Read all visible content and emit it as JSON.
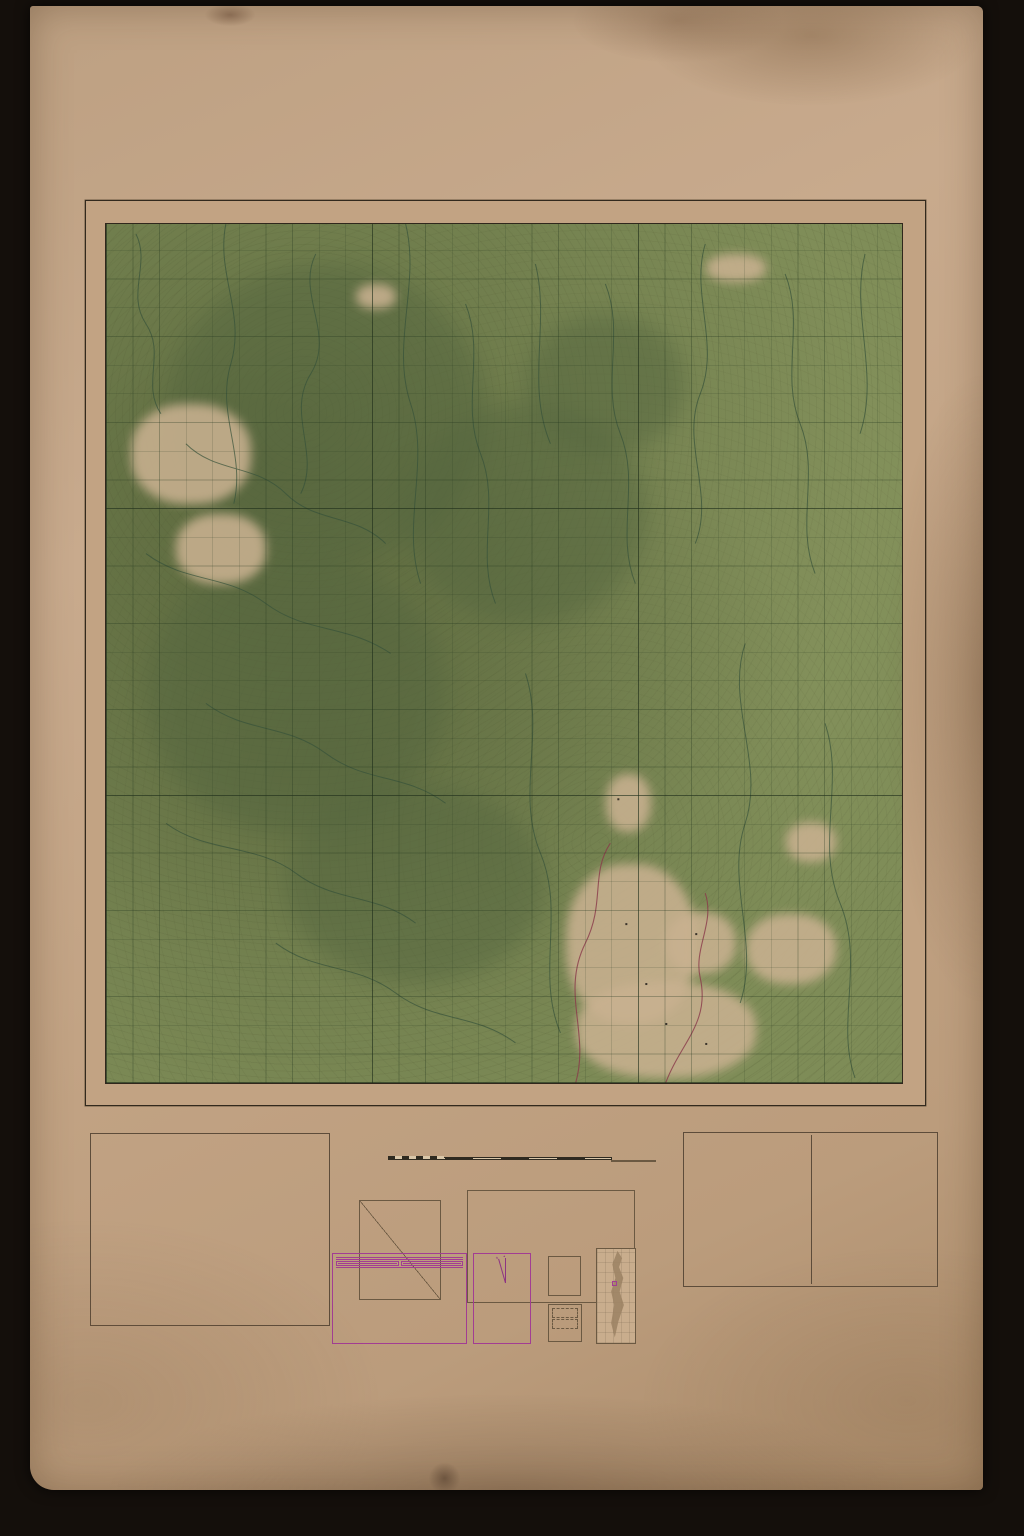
{
  "colors": {
    "paper": "#c2a384",
    "map_green": "#7e8c57",
    "forest_dark": "#55663f",
    "overprint_purple": "#5f2864",
    "magenta": "#a23d93",
    "emergency_magenta": "#b1308f",
    "road_red": "#96452f"
  },
  "header": {
    "districts_note": "PART OF DISTRICTS KINTA, KUALA KANGSAR (PERAK), ULU KELANTAN (KELANTAN) & CAMERON HIGHLANDS (PAHANG)",
    "title_line1": "PERAK,",
    "title_line2": "KELANTAN & PAHANG",
    "series_prefix": "AIR RECONNAISSANCE MAP 2",
    "series_fraction_top": "N",
    "series_fraction_bottom": "6",
    "sheet_name": "GUNONG KORBU"
  },
  "map": {
    "top_label_left": "KUALA KANGSAR",
    "top_label_right": "ULU KELANTAN",
    "bottom_label_left": "K I N T A",
    "bottom_label_right": "CAMERON HIGHLANDS",
    "left_label": "K I N T A",
    "right_label_top": "ULU KELANTAN",
    "right_label_bottom": "CAMERON HIGHLANDS",
    "overprint": "V K",
    "grid_cols": [
      "+10",
      "11",
      "12",
      "13",
      "14",
      "15",
      "16",
      "17",
      "18",
      "19",
      "+20",
      "21",
      "22",
      "23",
      "24",
      "25",
      "26",
      "27",
      "28",
      "29",
      "+30",
      "31",
      "32",
      "33",
      "34",
      "35",
      "36",
      "37",
      "38",
      "39"
    ],
    "grid_rows": [
      "+90",
      "89",
      "88",
      "87",
      "86",
      "85",
      "84",
      "83",
      "82",
      "81",
      "+80",
      "79",
      "78",
      "77",
      "76",
      "75",
      "74",
      "73",
      "72",
      "71",
      "+70",
      "69",
      "68",
      "67",
      "66",
      "65",
      "64",
      "63",
      "62",
      "61"
    ],
    "interior_labels": {
      "forest_reserve_1": "KORBU  FOREST  RESERVE",
      "forest_reserve_2": "KINTA  HILLS  FOREST  RESERVE",
      "jungle": "Jungle",
      "batu_gangan": "BATU GANGAN"
    },
    "corner_note": "101° 15´ E. of Greenwich",
    "watermark": "National Archives of Singapore"
  },
  "reference": {
    "title": "R E F E R E N C E",
    "rows": [
      {
        "c": "Railways",
        "t": "with Mile plate and Railway Station",
        "s": "railway"
      },
      {
        "t": "(1) Road under   (2) Road over   (3) Level Crossing   (4) Tunnel",
        "s": "railway"
      },
      {
        "c": "Bridges",
        "t": "Iron, Masonry, Reinforced Concrete, Wooden, Foot",
        "s": "bridge"
      },
      {
        "c": "Roads",
        "t": "1st Class metalled (unmetalled) with mile stone",
        "s": "road"
      },
      {
        "t": "2nd Class metalled or gravel but with possible restrictions as to load and/or width and surface",
        "s": "road"
      },
      {
        "t": "generally inferior to 1st class",
        "s": "road"
      },
      {
        "t": "Indifferent, may be used by motor vehicles but with difficulty and with restrictions",
        "s": "roaddash"
      },
      {
        "t": "Cart or Jeep track.   Footpath",
        "s": "track"
      },
      {
        "c": "Boundaries",
        "t": "(1) International   (2) State   (3) District",
        "s": "boundary"
      },
      {
        "t": "Forest Reserve with path.   Without path",
        "s": "boundary"
      },
      {
        "t": "Lines of Cultivation.   Wall or Fence",
        "s": "fence"
      },
      {
        "t": "Light railway.   Electric transmission line",
        "s": "line"
      },
      {
        "t": "Cemetery.   Buildings.   Lighthouse",
        "s": "buildings"
      },
      {
        "c": "Heights",
        "t": "Trigonometrical station with height.   Bench mark",
        "sym": "△7102   BM 4088"
      },
      {
        "t": "Theodolite or level.   Relative.   Other heights",
        "sym": "·4262   ·3976"
      },
      {
        "c": "Coastal features",
        "t": "(1) Sand   (2) Rocks   (3) Tidal river",
        "s": "blue"
      },
      {
        "t": "Lake and pond.   Service reservoir.   Impounding reservoir",
        "s": "blue"
      },
      {
        "c": "N.B. features",
        "t": "(1) Rocky outcrop   (2) Cliff, Precipice",
        "s": "rock"
      },
      {
        "t": "(3) Quarry   (4) Landslide",
        "s": "rock"
      },
      {
        "c": "Mines",
        "t": "(1) Mining land   (2) Mine hole with water",
        "s": "mine"
      },
      {
        "t": "(3) Mine hole without water",
        "s": "mine"
      },
      {
        "c": "Swamps",
        "t": "(1) Fresh water   (2) Tidal   (3) Lipak",
        "s": "swamp"
      },
      {
        "t": "Court House, Rest House, Halting Bungalow, Hospital",
        "sym": "C.H.  R.H.  H.B.  Hosp."
      },
      {
        "t": "Customs Station, Radio Station, Meteorological Station",
        "sym": "Cus.  R.S.  Met."
      },
      {
        "t": "Forest Reserve, Forest Checking Station, Dispensary, Padang",
        "sym": "F.R.  F.C.S.  Disp.  Pdg."
      },
      {
        "t": "Post & Telegraph Office,  Post Office",
        "sym": "P.T.O.   P.O."
      },
      {
        "t": "Police Station, Petrol Filling Station, School",
        "sym": "P.S.  P.F.S.  Sch."
      },
      {
        "t": "Co-ordinated Central Point.   Rifle Range",
        "sym": "⊕   Rifle Range"
      }
    ],
    "footer": "Published under the direction of the Surveyor General, Malaya."
  },
  "scale": {
    "projection": "Projection :   Modified Polyconic",
    "copyright_lines": [
      "Government Copyright reserved.",
      "This map may not be reproduced",
      "without the permission of the",
      "Survey Dept., Federation of Malaya."
    ],
    "scale_text": "Scale 1 Inch to a Mile or 1:63,360",
    "mile_left": "Mile 1",
    "mile_right": "2 Miles",
    "heights": "Heights in Feet",
    "diag": {
      "top": "17·58 Miles",
      "bottom": "17·58 Miles",
      "left": "19·82 Miles",
      "right": "19·82 Miles",
      "across": "26·46 Miles"
    }
  },
  "vegetation": {
    "title": "Vegetation",
    "subtitle": "By limit and name or abbreviation in black",
    "head_natural": "Natural",
    "head_tree": "Tree Cultivation",
    "head_minor": "Minor Cultivation",
    "natural": [
      [
        "Jungle: Dense Forest",
        "Jle"
      ],
      [
        "Belukar: Light Forest",
        "Blr. L.F."
      ],
      [
        "Grass. Casuarina Forest",
        "Gr. C.F."
      ],
      [
        "Brush",
        "Br."
      ],
      [
        "Grass and Brush",
        "G.B."
      ],
      [
        "Grass and Belukar",
        "G.Blr."
      ],
      [
        "Mangrove",
        "M."
      ],
      [
        "Other Classified",
        "By name"
      ],
      [
        "Clearings",
        "Cl."
      ]
    ],
    "tree": [
      [
        "Rubber",
        "R."
      ],
      [
        "Coconut",
        "Co."
      ],
      [
        "Oil Palm",
        "O.P."
      ],
      [
        "Other Classified",
        "By name"
      ],
      [
        "Unclassified and Mixed",
        "V.X."
      ]
    ],
    "minor": [
      [
        "Wet Rice Fields",
        "Pdi. Pa."
      ],
      [
        "Other Classified",
        "By name"
      ],
      [
        "Unclassified",
        "M.C."
      ]
    ]
  },
  "gridref": {
    "title": "TO GIVE A GRID REFERENCE ON THIS SHEET",
    "note1": "Map references are to the nearest hundred metres by the system of squares printed on this sheet",
    "note2": "PAY ATTENTION TO LARGER MARGINAL FIGURES  viz  +10",
    "point_label": "POINT",
    "point_value": "G. Yong Belar (Trig.)",
    "east_head": "EAST",
    "north_head": "NORTH",
    "east_text": "Take west edge of the square in which point lies and read the figures printed opposite on the north or south margin. Estimate tenths eastwards.",
    "east_val": "31·5",
    "north_text": "Take south edge of the square in which point lies and read the figures printed opposite on the east or west margin. Estimate tenths northwards.",
    "north_val": "72·5",
    "footer_left": "EAST  315",
    "footer_right": "NORTH  725",
    "ref_line": "REFERENCE   315725"
  },
  "magnetic": {
    "title": "MAGNETIC DECLINATION ABOUT",
    "value": "1° 00´ E. (JAN. 1948)",
    "annual": "Annual change negligible",
    "grid_title": "MALAYAN GRID",
    "rows": [
      [
        "PROJECTION",
        "CASSINI"
      ],
      [
        "BEARINGS",
        "GRID"
      ],
      [
        "ORIGIN",
        "4° N., 102° E."
      ],
      [
        "FALSE COORDS.",
        "OF ORIGIN"
      ],
      [
        "500,000 YDS. E.",
        "0 YDS. N."
      ]
    ]
  },
  "reliability": {
    "title": "RELIABILITY",
    "regions": [
      "1",
      "2",
      "3"
    ],
    "note": "SEE NOTES"
  },
  "photos": {
    "title": "Index to Photographs"
  },
  "adjoining": {
    "title": "Index to adjoining sheets",
    "cells": [
      "",
      "2 N/2",
      "",
      "2 N/5",
      "2 N/6",
      "2 N/7",
      "",
      "2 N/10",
      ""
    ]
  },
  "glossary": {
    "title": "GLOSSARY OF MALAY TOPOGRAPHICAL TERMS WITH ABBREVIATIONS USED",
    "left": [
      [
        "Alur  (A.)",
        "Deep channel of river, hollow, pass"
      ],
      [
        "Ayer",
        "Water"
      ],
      [
        "Ayer Terjun",
        "Waterfall"
      ],
      [
        "Bagan",
        "Landing place, fishing village"
      ],
      [
        "Batu",
        "Stone, rock"
      ],
      [
        "Belukar  (Blk.)",
        "Secondary jungle"
      ],
      [
        "Bendang",
        "Rice swamp"
      ],
      [
        "Bukit  (Bt.)",
        "Hill"
      ],
      [
        "Changkat  (Chat.)",
        "Hillock"
      ],
      [
        "Charok  (C.)",
        "Small stream"
      ],
      [
        "Danau",
        "Fresh water pond"
      ],
      [
        "Genting  (Gtg.)",
        "Pass, col"
      ],
      [
        "Gunong  (G.)",
        "Mountain"
      ],
      [
        "Hilir  (Hr.)",
        "Downstream region"
      ],
      [
        "Istana",
        "Palace"
      ],
      [
        "Jalan",
        "Road, way"
      ],
      [
        "Jeram  (J.)",
        "Rapids"
      ],
      [
        "Kampong  (Kg.)",
        "Village"
      ],
      [
        "Kota",
        "Fort"
      ],
      [
        "Kuala  (K.)",
        "River mouth"
      ],
      [
        "Kubang",
        "Wallow"
      ],
      [
        "Labohan",
        "Anchorage"
      ],
      [
        "Ladang  (Ldg.)",
        "Cultivated clearing"
      ],
      [
        "Lalang  (L.)",
        "Long wild grass"
      ],
      [
        "Laut",
        "Sea"
      ],
      [
        "Lepah",
        "Depression, swamp"
      ]
    ],
    "right": [
      [
        "Lubok  (Lbk.)",
        "Deep pool"
      ],
      [
        "Nipah  (Nip.)",
        "Palm used for thatching"
      ],
      [
        "Padang  (Pdg.)",
        "Open space, sports field, marshland"
      ],
      [
        "Pantai",
        "Beach"
      ],
      [
        "Parit  (Pt.)",
        "Ditch, drain"
      ],
      [
        "Pasir",
        "Sand"
      ],
      [
        "Paya",
        "Permanent swamp"
      ],
      [
        "Pangkalan  (Peng.)",
        "Wharf"
      ],
      [
        "Permatang  (Pmtg.)",
        "Rising ground in flat country"
      ],
      [
        "Pulau  (P.)",
        "Island"
      ],
      [
        "Rantau",
        "Reach of river or of sea coast"
      ],
      [
        "Rasau",
        "Fern, riverine"
      ],
      [
        "Rimba",
        "Virgin jungle"
      ],
      [
        "Rumbia",
        "Palm used for thatching"
      ],
      [
        "Sakai Ladang  (S. Ldg.)",
        "Cultivated clearing of aborigines"
      ],
      [
        "Selat",
        "Strait"
      ],
      [
        "Simpang",
        "Crossroads"
      ],
      [
        "Sira",
        "Salt-lick"
      ],
      [
        "Sungei  (S.)",
        "River, stream"
      ],
      [
        "Tali Ayer  (T. A.)",
        "Artificial water channel"
      ],
      [
        "Tanjong  (Tg.)",
        "Promontory"
      ],
      [
        "Tasek",
        "Lake"
      ],
      [
        "Telok  (T.)",
        "Bay, in-curved bend of river bank"
      ],
      [
        "Terusan",
        "Channel"
      ],
      [
        "Tuban",
        "Sunken rock"
      ],
      [
        "Ulu, Hulu",
        "Upstream region"
      ]
    ]
  },
  "notes": {
    "omitted_intro": "The following features are omitted :",
    "omitted": [
      "Cuttings and Embankments",
      "Telegraph or Telephone Lines",
      "Places of Worship",
      "Muslim Shrines and Boundaries"
    ],
    "see_note": "See Reliability Diagram",
    "survey": [
      "(1) Rigid Survey 1930.  Revised from air photographs 1952.",
      "(2) Rigid Survey 1931.  Revised from air photographs 1952.",
      "(3) Compiled 1937 from air photographs with limited existing ground survey."
    ],
    "photo_covers": "Photo cover areas shown thus",
    "photo_sym": "▷◁",
    "photo_ref": "B KUNTH  3048",
    "emergency": "EMERGENCY ISSUE",
    "dept": "Survey Dept. Federation of Malaya No. 88 53"
  },
  "footer_notes": {
    "area12_label": "AREA 1 & 2",
    "area12_text": "CONTOURS:  VERTICAL INTERVAL 50 FEET.  RELIEF IN THIS AREA IS EMPHASIZED OWING TO THE CLOSE 50 FEET CONTOUR INTERVAL.",
    "area3_label": "AREA 3",
    "area3_text": "RELIEF LINES:  GIVE LOCAL INDICATION OF RISING GROUND, BUT DO NOT MAINTAIN CONSTANT HEIGHT AND ARE NOT CONTOURS."
  },
  "annotations": {
    "accession": "Acc  383"
  }
}
